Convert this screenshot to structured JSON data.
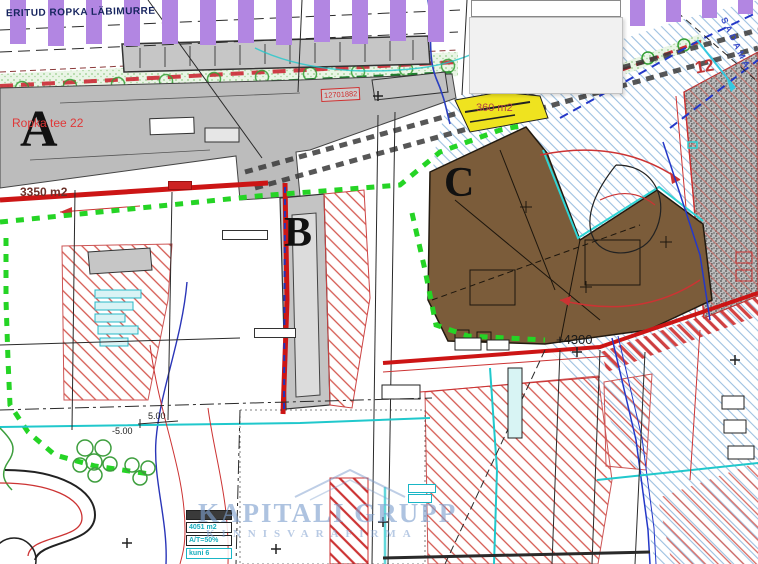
{
  "map": {
    "top_note": "ERITUD ROPKA LÄBIMURRE",
    "plots": {
      "a": "A",
      "b": "B",
      "c": "C",
      "neighbor": "12"
    },
    "texts": {
      "street_name": "Ropka tee 22",
      "area_a": "3350 m2",
      "area_c": "360 m2",
      "cadastral_ref": "12701882",
      "dim_mark": "+4300",
      "elevation_1": "5.00",
      "elevation_2": "-5.00",
      "railway_name": "SADAMA"
    },
    "info_boxes": [
      "4051 m2",
      "A/T=50%",
      "kuni 6"
    ],
    "watermark": {
      "line1": "KAPITALI GRUPP",
      "line2": "KINNISVARAFIRMA"
    },
    "colors": {
      "boundary_green": "#25d425",
      "boundary_red": "#cc1515",
      "plot_c_brown": "#7b5c3a",
      "plot_gray": "#bcbcbc",
      "planned_road_purple": "#b286e2",
      "hatch_blue": "#9cc0e0",
      "hatch_red": "#d4574e",
      "utility_cyan": "#20c8cc",
      "watermark_blue": "#7d9ecd"
    }
  }
}
